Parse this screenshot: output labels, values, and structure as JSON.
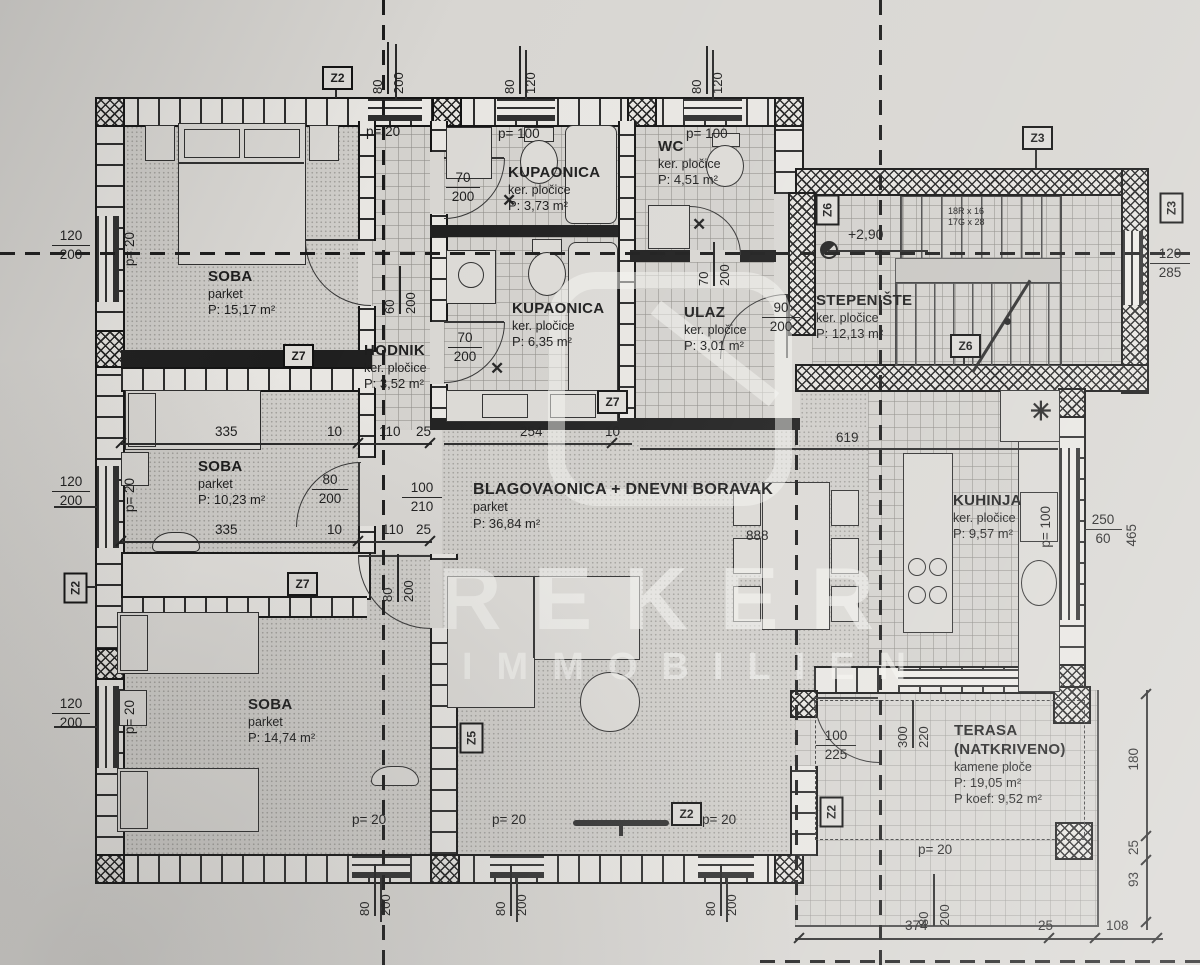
{
  "plan": {
    "watermark": {
      "line1": "REKER",
      "line2": "IMMOBILIEN"
    },
    "rooms": {
      "soba1": {
        "name": "SOBA",
        "floor": "parket",
        "area": "P: 15,17 m²"
      },
      "soba2": {
        "name": "SOBA",
        "floor": "parket",
        "area": "P: 10,23 m²"
      },
      "soba3": {
        "name": "SOBA",
        "floor": "parket",
        "area": "P: 14,74 m²"
      },
      "kupaonica1": {
        "name": "KUPAONICA",
        "floor": "ker. pločice",
        "area": "P: 3,73 m²"
      },
      "kupaonica2": {
        "name": "KUPAONICA",
        "floor": "ker. pločice",
        "area": "P: 6,35 m²"
      },
      "wc": {
        "name": "WC",
        "floor": "ker. pločice",
        "area": "P: 4,51 m²"
      },
      "ulaz": {
        "name": "ULAZ",
        "floor": "ker. pločice",
        "area": "P: 3,01 m²"
      },
      "hodnik": {
        "name": "HODNIK",
        "floor": "ker. pločice",
        "area": "P: 3,52 m²"
      },
      "stepeniste": {
        "name": "STEPENIŠTE",
        "floor": "ker. pločice",
        "area": "P: 12,13 m²"
      },
      "blagovaonica": {
        "name": "BLAGOVAONICA + DNEVNI BORAVAK",
        "floor": "parket",
        "area": "P: 36,84 m²"
      },
      "kuhinja": {
        "name": "KUHINJA",
        "floor": "ker. pločice",
        "area": "P: 9,57 m²"
      },
      "terasa": {
        "name": "TERASA",
        "name2": "(NATKRIVENO)",
        "floor": "kamene ploče",
        "area": "P: 19,05 m²",
        "area2": "P koef: 9,52 m²"
      }
    },
    "stairs": {
      "level": "+2,90",
      "spec1": "18R x 16",
      "spec2": "17G x 28",
      "steps": [
        "16",
        "15",
        "14",
        "13",
        "12",
        "11"
      ]
    },
    "labels": {
      "p20": "p= 20",
      "p100": "p= 100",
      "n10": "10",
      "n25": "25",
      "n60": "60",
      "n70": "70",
      "n80": "80",
      "n90": "90",
      "n93": "93",
      "n100": "100",
      "n108": "108",
      "n110": "110",
      "n120": "120",
      "n180": "180",
      "n200": "200",
      "n210": "210",
      "n220": "220",
      "n225": "225",
      "n250": "250",
      "n254": "254",
      "n285": "285",
      "n300": "300",
      "n335": "335",
      "n374": "374",
      "n465": "465",
      "n619": "619",
      "n888": "888"
    },
    "markers": {
      "z2": "Z2",
      "z3": "Z3",
      "z5": "Z5",
      "z6": "Z6",
      "z7": "Z7"
    }
  }
}
